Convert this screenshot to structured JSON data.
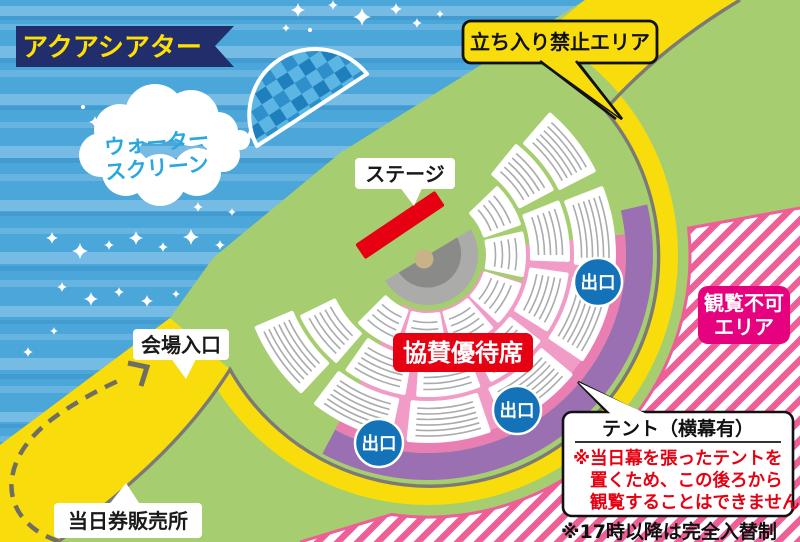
{
  "banner": {
    "label": "アクアシアター"
  },
  "water_screen": {
    "line1": "ウォーター",
    "line2": "スクリーン"
  },
  "stage_callout": {
    "label": "ステージ"
  },
  "no_entry_callout": {
    "label": "立ち入り禁止エリア"
  },
  "entrance_callout": {
    "label": "会場入口"
  },
  "ticket_callout": {
    "label": "当日券販売所"
  },
  "sponsor_label": {
    "label": "協賛優待席"
  },
  "exit_label": {
    "label": "出口"
  },
  "no_view_badge": {
    "line1": "観覧不可",
    "line2": "エリア"
  },
  "tent_callout": {
    "title": "テント（横幕有）",
    "note1": "※当日幕を張ったテントを",
    "note2": "置くため、この後ろから",
    "note3": "観覧することはできません"
  },
  "footnote": {
    "label": "※17時以降は完全入替制"
  },
  "colors": {
    "water": "#4ba6da",
    "land": "#a6ce70",
    "road": "#f8dc0b",
    "fence": "#7b7a74",
    "purple": "#9b70b2",
    "pink": "#f09cc6",
    "pink_dark": "#e87eb2",
    "stripe": "#ee5f97",
    "badge_magenta": "#e6017e",
    "red": "#e60012",
    "exit_blue": "#1372b8",
    "navy": "#222e6b",
    "banner_text": "#ffe000",
    "cloud_text": "#29a8e0",
    "seat_row": "#a9abad",
    "pool_gray": "#ababa9",
    "pool_dark": "#8a8a88",
    "pool_hub": "#c8b288",
    "screen_blue_light": "#5cb6e4",
    "screen_blue": "#2e8fcb"
  }
}
